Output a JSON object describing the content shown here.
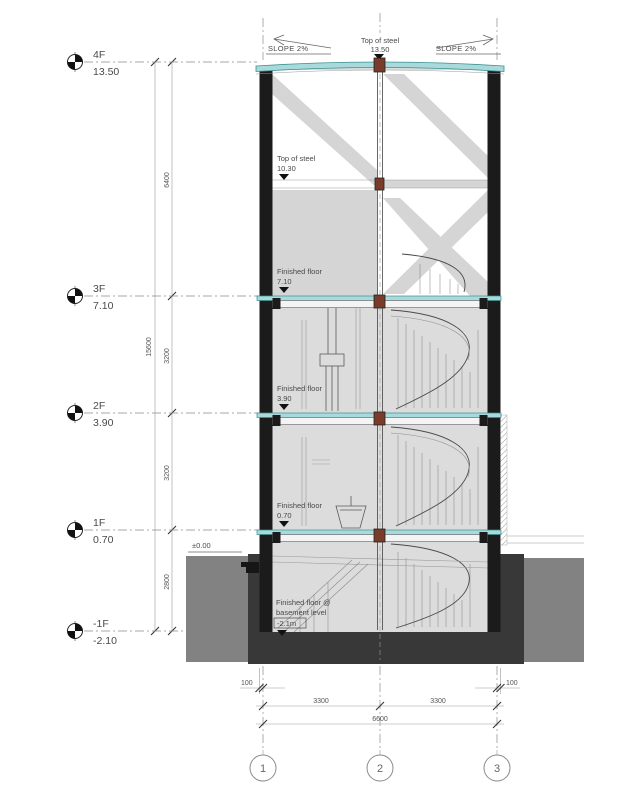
{
  "levels": [
    {
      "name": "4F",
      "elev": "13.50"
    },
    {
      "name": "3F",
      "elev": "7.10"
    },
    {
      "name": "2F",
      "elev": "3.90"
    },
    {
      "name": "1F",
      "elev": "0.70"
    },
    {
      "name": "-1F",
      "elev": "-2.10"
    }
  ],
  "roof": {
    "slope_left": "SLOPE 2%",
    "slope_right": "SLOPE 2%",
    "label": "Top of steel",
    "value": "13.50"
  },
  "notes": {
    "steel_label": "Top of steel",
    "steel_value": "10.30",
    "ff3_label": "Finished floor",
    "ff3_value": "7.10",
    "ff2_label": "Finished floor",
    "ff2_value": "3.90",
    "ff1_label": "Finished floor",
    "ff1_value": "0.70",
    "ffb_l1": "Finished floor @",
    "ffb_l2": "basement level",
    "ffb_value": "-2.1m",
    "ground": "±0.00"
  },
  "dims": {
    "overall_v": "15600",
    "v": [
      "6400",
      "3200",
      "3200",
      "2800"
    ],
    "edge_left": "100",
    "edge_right": "100",
    "bays": [
      "3300",
      "3300"
    ],
    "overall_h": "6600"
  },
  "grids": [
    "1",
    "2",
    "3"
  ],
  "colors": {
    "glass": "#a9dadb",
    "glass_edge": "#3d8f8f",
    "node": "#7a3c2a",
    "earth": "#828282",
    "foundation": "#383838",
    "wall": "#1b1b1b",
    "interior": "#dcdcdc",
    "brace": "#d5d5d5"
  }
}
